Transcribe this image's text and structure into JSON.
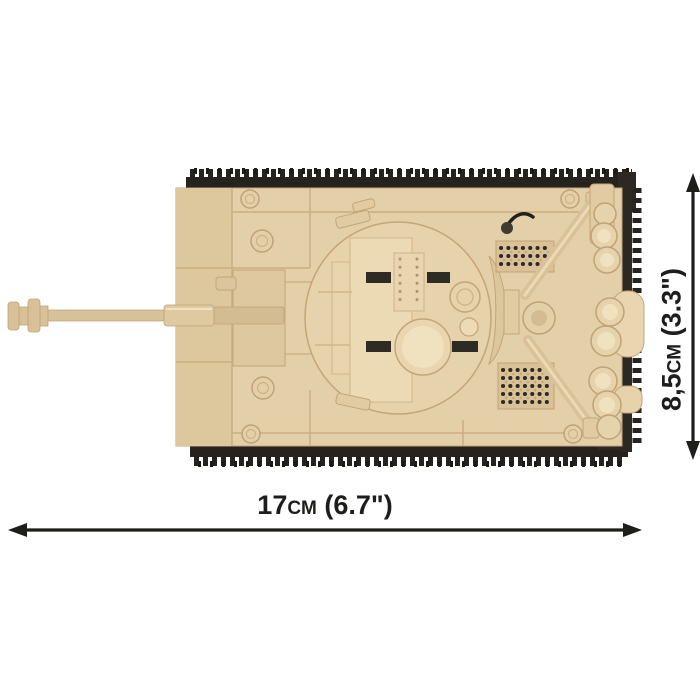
{
  "dimensions": {
    "width_label": "17cm (6.7\")",
    "height_label": "8,5cm (3.3\")"
  },
  "illustration": {
    "subject": "brick-built-tank-top-view",
    "parts": [
      "muzzle-brake",
      "gun-barrel",
      "hull",
      "turret",
      "turret-hatch",
      "top-track",
      "bottom-track",
      "engine-grilles",
      "tow-cables",
      "rear-cylinders",
      "antenna"
    ],
    "palette": {
      "brick_tan": "#e4d0a8",
      "brick_tan_light": "#f0e1bf",
      "brick_tan_dark": "#d3bc92",
      "brick_edge": "#c3a578",
      "track_black": "#26221e",
      "annotation_black": "#1d1d1b",
      "background": "#ffffff"
    }
  }
}
